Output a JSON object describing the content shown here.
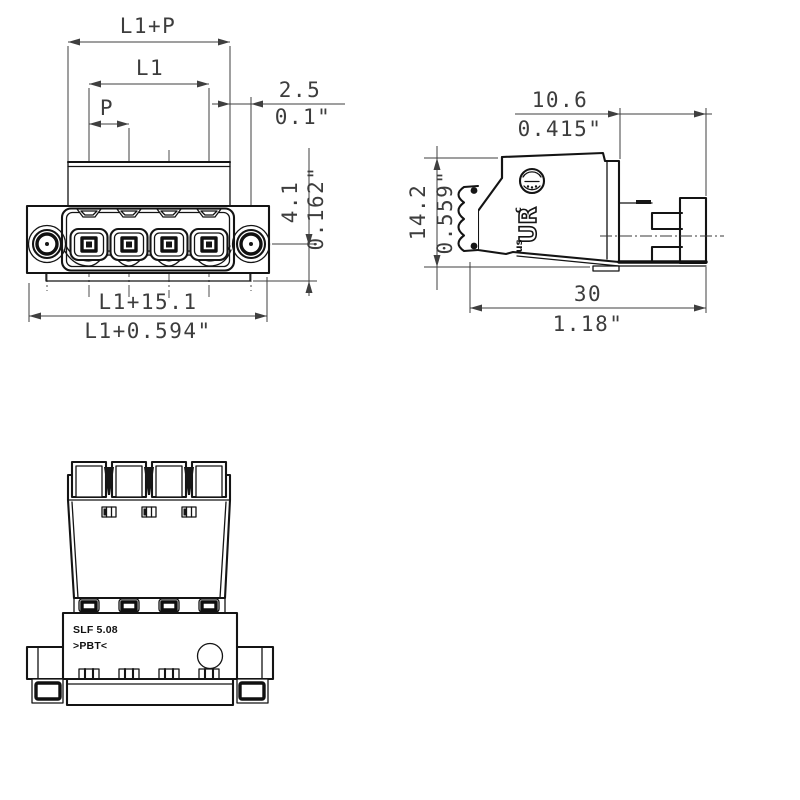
{
  "drawing": {
    "dimensions": {
      "l1_plus_p": "L1+P",
      "l1": "L1",
      "p": "P",
      "pin_offset_mm": "2.5",
      "pin_offset_in": "0.1\"",
      "depth_mm": "4.1",
      "depth_in": "0.162\"",
      "width_total_mm": "L1+15.1",
      "width_total_in": "L1+0.594\"",
      "side_top_mm": "10.6",
      "side_top_in": "0.415\"",
      "side_height_mm": "14.2",
      "side_height_in": "0.559\"",
      "side_length_mm": "30",
      "side_length_in": "1.18\""
    },
    "markings": {
      "type_label": "SLF 5.08",
      "material_label": ">PBT<",
      "ul_c": "c",
      "ul_ur": "UR",
      "ul_us": "us"
    },
    "colors": {
      "line": "#141414",
      "dimension": "#3f3f3f",
      "background": "#ffffff"
    }
  }
}
